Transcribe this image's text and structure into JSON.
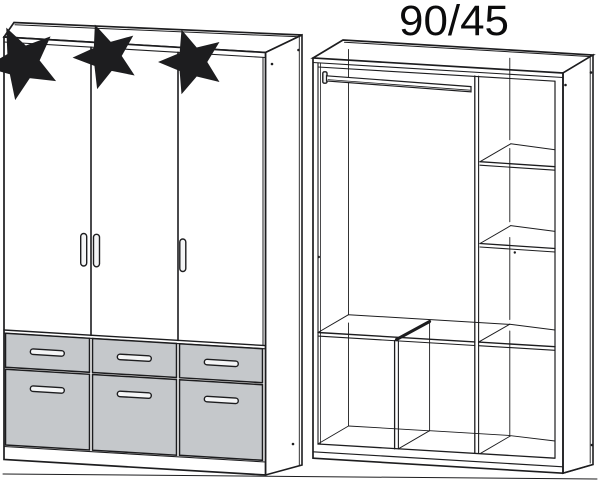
{
  "title": "90/45",
  "colors": {
    "line": "#1d1d1f",
    "drawer_fill": "#c5c8cb",
    "handle_fill": "#f4f5f6",
    "background": "#ffffff"
  },
  "icons": {
    "star_icon": "☆"
  },
  "left_wardrobe": {
    "name": "wardrobe front view",
    "doors": 3,
    "door_stars": 3,
    "drawer_rows": 2,
    "drawer_columns": 3,
    "drawers": 6
  },
  "right_wardrobe": {
    "name": "wardrobe interior view",
    "clothes_rails": 1,
    "side_shelves": 2,
    "full_width_shelves": 1,
    "bottom_compartments": 3
  }
}
